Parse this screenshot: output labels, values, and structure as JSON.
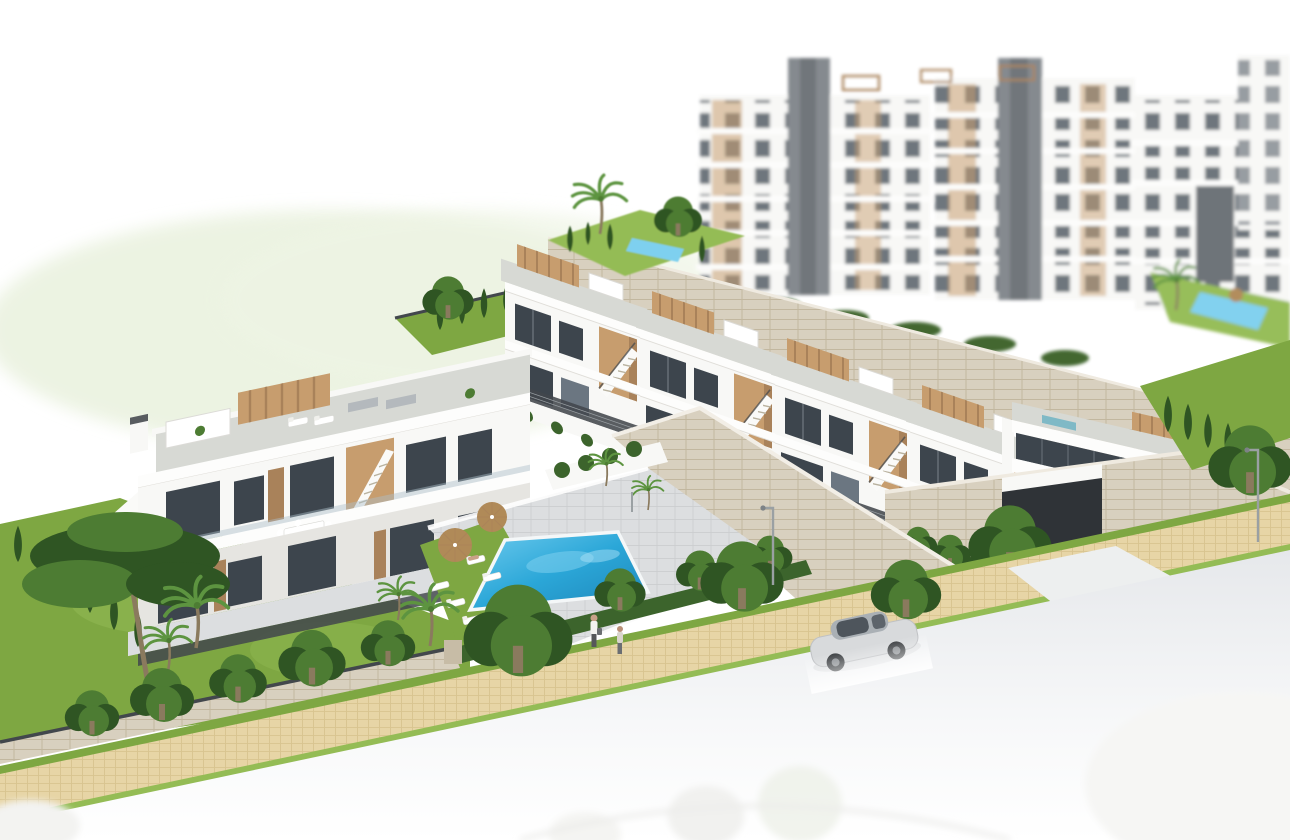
{
  "meta": {
    "type": "3d-architectural-render",
    "view": "aerial-isometric",
    "visible_text": "none",
    "description": "Photorealistic marketing render of a modern white Mediterranean residential development on a hillside: a stepped row of townhouses with tan stair towers and roof terraces, a two-storey apartment block on the left, a communal pool with sun loungers and parasols, stone retaining walls, an underground garage with a car exiting, a cobbled sidewalk and street with a silver car and two pedestrians, and blurred multi-storey apartment buildings in the background."
  },
  "scene": {
    "background": {
      "apartment_blocks": 4,
      "elevator_cores": 2,
      "rooftop_pergolas": 3,
      "hillside_pools": 2,
      "haze_hill": "pale green blurred meadow upper-left"
    },
    "midground": {
      "townhouse_units": 4,
      "corner_building": 1,
      "left_apartment_block": 1,
      "stair_towers_material": "tan wood-clad",
      "roof_terraces": "grey gravel decks with pergolas and loungers",
      "retaining_walls": "beige dry stone"
    },
    "amenities": {
      "swimming_pool": 1,
      "pool_shape": "rotated rectangle",
      "sun_loungers": 7,
      "parasols": 2,
      "pool_lawn": true,
      "garage_entrance": 1
    },
    "street": {
      "sidewalk": "beige cobblestone with grass verges",
      "road": "light asphalt fading to white",
      "silver_car": 1,
      "dark_car_at_garage": 1,
      "ghost_cars_bottom": 2,
      "pedestrians": 2,
      "street_lamps": 2
    },
    "vegetation": {
      "pine_trees": 1,
      "palm_trees": 5,
      "cypress_trees": 16,
      "round_trees": 7,
      "hedge_rows": 4
    }
  },
  "palette": {
    "background": "#ffffff",
    "hill_green": "#e9f1de",
    "bldg_white": "#f8f8f6",
    "parapet_white": "#fdfdfc",
    "bldg_shadow": "#e6e5e1",
    "roof_deck": "#c2c4bf",
    "roof_deck_light": "#d7d9d4",
    "window_dark": "#3d454d",
    "window_mid": "#6b7681",
    "glass_blue": "#aebfc9",
    "wood": "#c79d6e",
    "wood_dark": "#a9825a",
    "core_gray": "#82878c",
    "stone": "#d8d0bf",
    "stone_line": "#c2b79f",
    "pool_blue": "#2ba7d8",
    "pool_deep": "#1e94c8",
    "pool_light": "#7ed0ef",
    "lawn": "#7ea742",
    "lawn_light": "#94bc55",
    "tree": "#4d7c33",
    "tree_dark": "#2f5523",
    "hedge": "#3c642c",
    "palm_green": "#5d9440",
    "trunk_brown": "#8a7a5e",
    "pave_gray": "#c8cacc",
    "pave_light": "#dcdee0",
    "cobble": "#e7d5a6",
    "cobble_line": "#d6c18c",
    "road_gray": "#e8eaed",
    "car_silver": "#d8dadc",
    "car_dark": "#62666b",
    "rail_dark": "#42474c",
    "umbrella_tan": "#b08a58",
    "skin": "#c8a188"
  }
}
